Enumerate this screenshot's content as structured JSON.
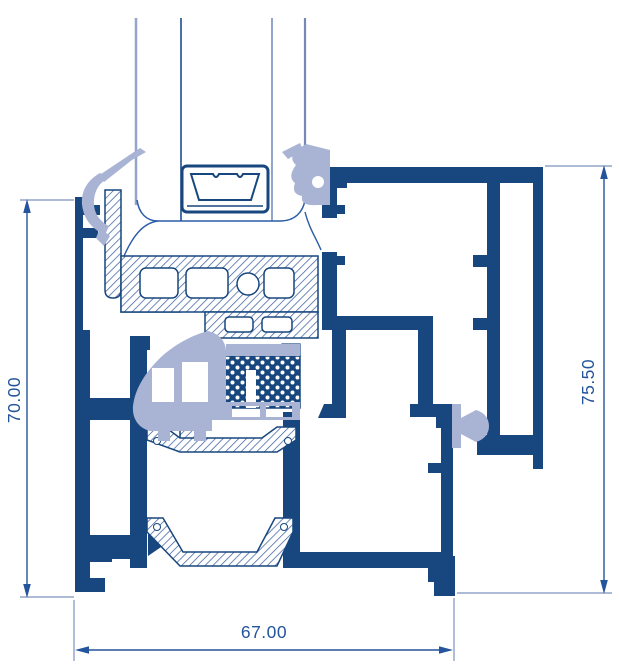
{
  "drawing": {
    "type": "cross-section-diagram",
    "dimensions": {
      "left_height": "70.00",
      "right_height": "75.50",
      "bottom_width": "67.00"
    },
    "colors": {
      "profile_navy": "#17477E",
      "gasket_lavender": "#A9B3D4",
      "hatch_line": "#3E62A0",
      "dimension_line": "#24549C",
      "extension_line": "#7C92BE",
      "glass_line": "#94A5CB",
      "background": "#FFFFFF"
    }
  }
}
